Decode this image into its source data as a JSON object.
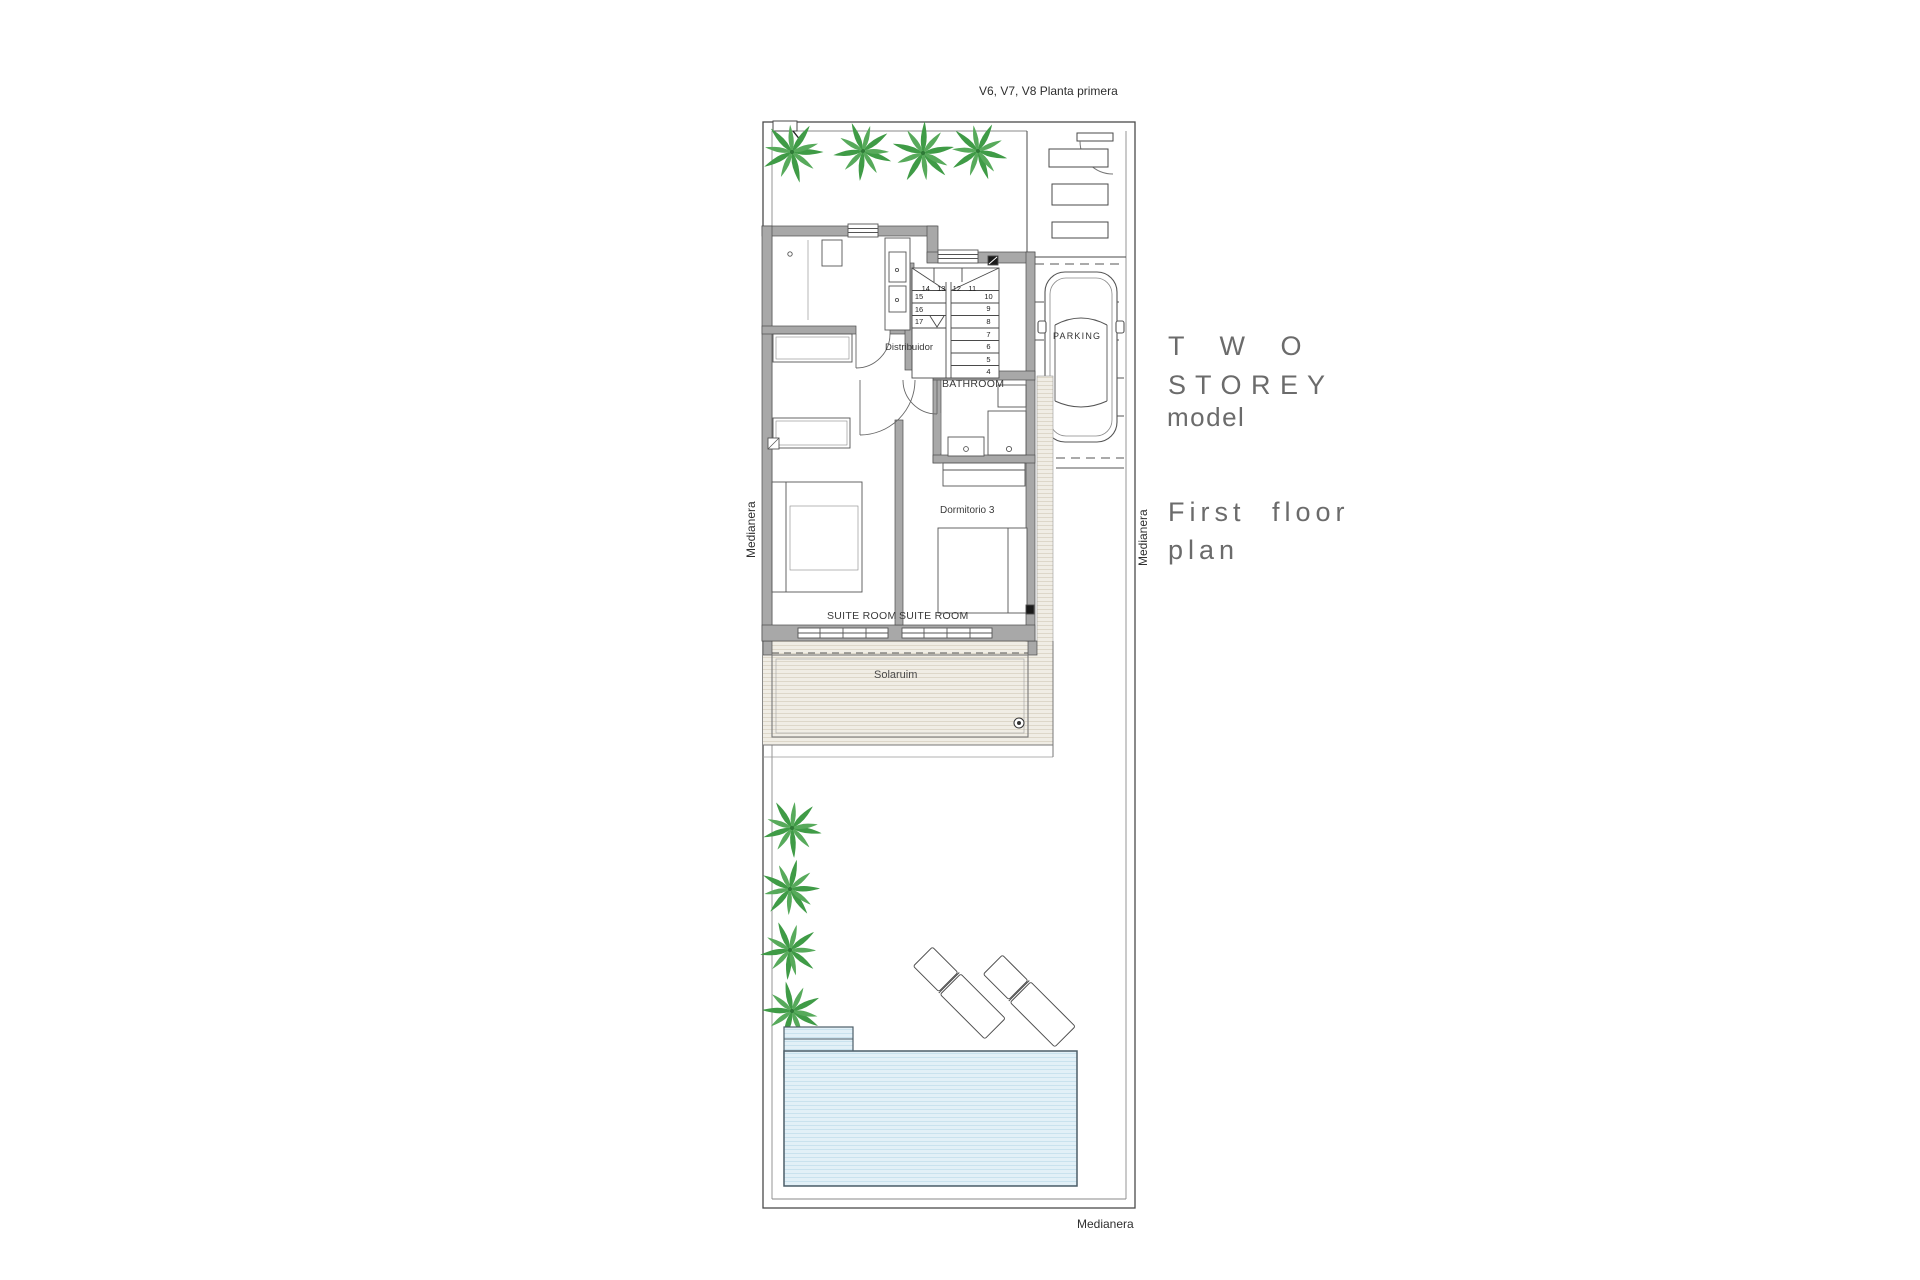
{
  "title": "V6, V7, V8 Planta primera",
  "side_panel": {
    "model_line1": "T W O",
    "model_line2": "S T O R E Y",
    "model_line3": "model",
    "plan_line1": "First floor",
    "plan_line2": "plan"
  },
  "plan": {
    "labels": {
      "distribuidor": "Distribuidor",
      "bathroom": "BATHROOM",
      "dormitorio3": "Dormitorio 3",
      "suite_room_left": "SUITE ROOM",
      "suite_room_right": "SUITE ROOM",
      "solarium": "Solaruim",
      "parking": "PARKING"
    },
    "boundary_labels": {
      "left": "Medianera",
      "right": "Medianera",
      "bottom": "Medianera"
    },
    "stairs": {
      "top_row": [
        "14",
        "13",
        "12",
        "11"
      ],
      "left_col": [
        "15",
        "16",
        "17"
      ],
      "right_col": [
        "10",
        "9",
        "8",
        "7",
        "6",
        "5",
        "4"
      ]
    }
  },
  "colors": {
    "wall_fill": "#a8a8a8",
    "wall_stroke": "#4d4d4d",
    "line": "#4a4a4a",
    "palm_green": "#3f9b46",
    "palm_green_light": "#57aa5b",
    "pool_fill": "#e2f0f7",
    "pool_stripe": "#c9e2ee",
    "pool_stroke": "#4d5e68",
    "hatch_bg": "#f0ede5",
    "hatch_line": "#ddd7c9",
    "label_text": "#3a3a3a",
    "side_text": "#6b6b6b"
  }
}
